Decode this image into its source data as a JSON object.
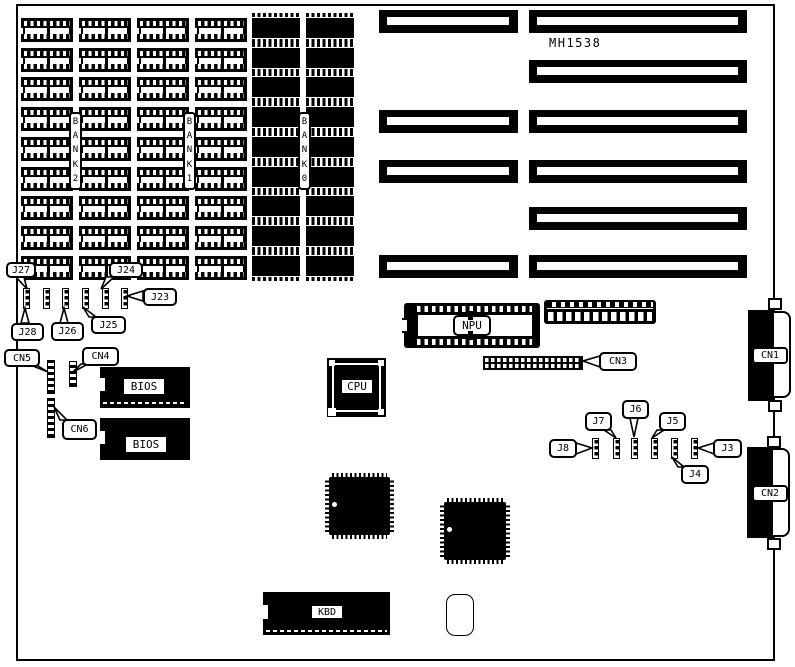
{
  "board": {
    "model": "MH1538",
    "bank_labels": {
      "bank2": "BANK2",
      "bank1": "BANK1",
      "bank0": "BANK0"
    },
    "chips": {
      "npu": "NPU",
      "cpu": "CPU",
      "bios_top": "BIOS",
      "bios_bottom": "BIOS",
      "kbd": "KBD"
    },
    "connectors": {
      "cn1": "CN1",
      "cn2": "CN2",
      "cn3": "CN3",
      "cn4": "CN4",
      "cn5": "CN5",
      "cn6": "CN6"
    },
    "jumpers": {
      "j3": "J3",
      "j4": "J4",
      "j5": "J5",
      "j6": "J6",
      "j7": "J7",
      "j8": "J8",
      "j23": "J23",
      "j24": "J24",
      "j25": "J25",
      "j26": "J26",
      "j27": "J27",
      "j28": "J28"
    },
    "colors": {
      "ink": "#000000",
      "paper": "#ffffff"
    }
  }
}
